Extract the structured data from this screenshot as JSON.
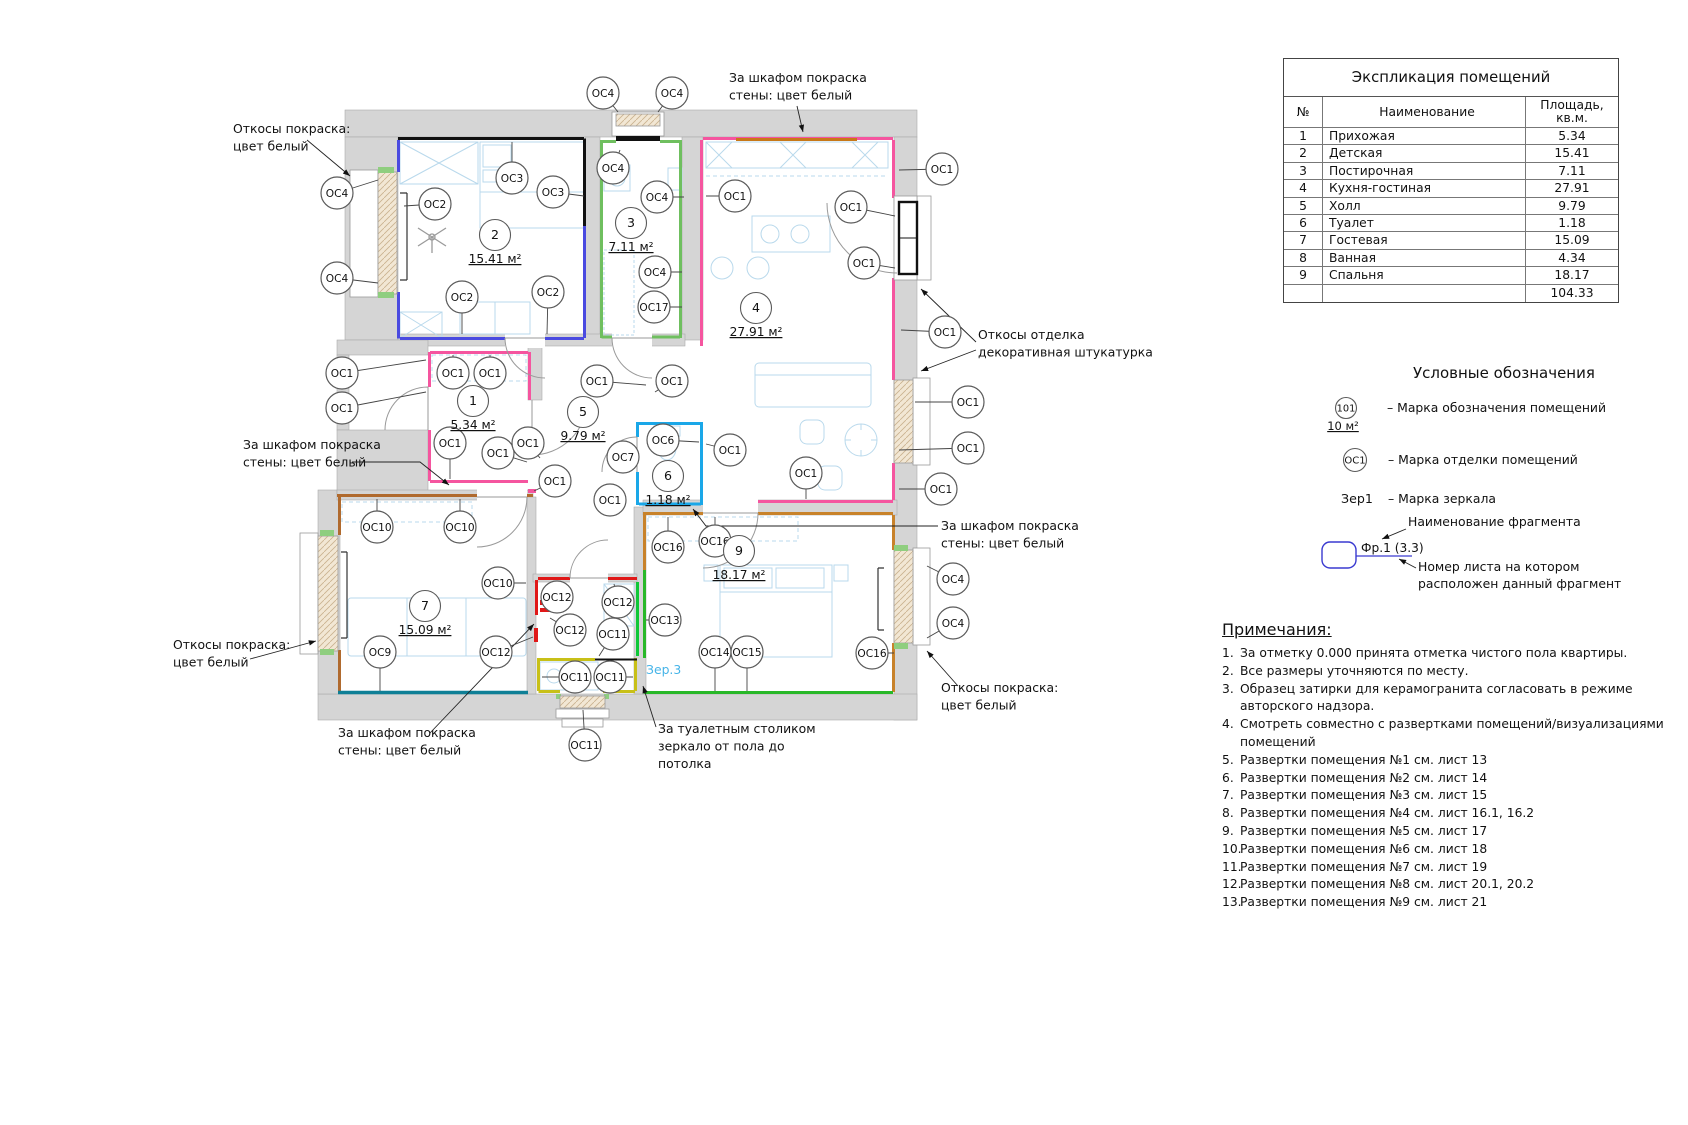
{
  "table": {
    "title": "Экспликация помещений",
    "col_no": "№",
    "col_name": "Наименование",
    "col_area": "Площадь, кв.м.",
    "rows": [
      [
        "1",
        "Прихожая",
        "5.34"
      ],
      [
        "2",
        "Детская",
        "15.41"
      ],
      [
        "3",
        "Постирочная",
        "7.11"
      ],
      [
        "4",
        "Кухня-гостиная",
        "27.91"
      ],
      [
        "5",
        "Холл",
        "9.79"
      ],
      [
        "6",
        "Туалет",
        "1.18"
      ],
      [
        "7",
        "Гостевая",
        "15.09"
      ],
      [
        "8",
        "Ванная",
        "4.34"
      ],
      [
        "9",
        "Спальня",
        "18.17"
      ]
    ],
    "total": "104.33"
  },
  "legend": {
    "title": "Условные обозначения",
    "room_mark": {
      "circle": "101",
      "area": "10 м²",
      "desc": "– Марка обозначения помещений"
    },
    "finish_mark": {
      "circle": "ОС1",
      "desc": "– Марка отделки помещений"
    },
    "mirror_mark": {
      "label": "Зер1",
      "desc": "– Марка зеркала"
    },
    "fragment": {
      "label": "Фр.1 (3.3)",
      "ann_name": "Наименование фрагмента",
      "ann_sheet_1": "Номер листа на котором",
      "ann_sheet_2": "расположен данный фрагмент"
    }
  },
  "notes": {
    "title": "Примечания:",
    "items": [
      "За отметку 0.000 принята отметка чистого пола квартиры.",
      "Все размеры уточняются по месту.",
      "Образец затирки для керамогранита согласовать в режиме авторского надзора.",
      "Смотреть совместно с развертками помещений/визуализациями помещений",
      "Развертки помещения №1 см. лист 13",
      "Развертки помещения №2 см. лист 14",
      "Развертки помещения №3 см. лист 15",
      "Развертки помещения №4 см. лист 16.1, 16.2",
      "Развертки помещения №5 см. лист 17",
      "Развертки помещения №6 см. лист 18",
      "Развертки помещения №7 см. лист 19",
      "Развертки помещения №8 см. лист 20.1, 20.2",
      "Развертки помещения №9 см. лист 21"
    ]
  },
  "plan": {
    "colors": {
      "wall_gray": "#d5d5d5",
      "blue": "#4a4ae0",
      "green_room3": "#6fbf5f",
      "pink": "#f5559f",
      "cyan": "#1aa7e8",
      "brown_room7": "#b06a2e",
      "teal": "#0e7f96",
      "brown_room9": "#c8822a",
      "green_room9": "#28b828",
      "red": "#e01818",
      "yellow": "#c8c018",
      "green_bath": "#10c838",
      "orange_wardrobe": "#c87818",
      "window_tan": "#f2e7d4",
      "furniture_blue": "#b9d9ec",
      "mirror_blue": "#46b4e8",
      "fragment_blue": "#3a3ad0"
    },
    "mirror_label": {
      "text": "Зер.3",
      "x": 646,
      "y": 674
    },
    "rooms": [
      {
        "n": "1",
        "a": "5.34 м²",
        "x": 473,
        "y": 401
      },
      {
        "n": "2",
        "a": "15.41 м²",
        "x": 495,
        "y": 235
      },
      {
        "n": "3",
        "a": "7.11 м²",
        "x": 631,
        "y": 223
      },
      {
        "n": "4",
        "a": "27.91 м²",
        "x": 756,
        "y": 308
      },
      {
        "n": "5",
        "a": "9.79 м²",
        "x": 583,
        "y": 412
      },
      {
        "n": "6",
        "a": "1.18 м²",
        "x": 668,
        "y": 476
      },
      {
        "n": "7",
        "a": "15.09 м²",
        "x": 425,
        "y": 606
      },
      {
        "n": "9",
        "a": "18.17 м²",
        "x": 739,
        "y": 551
      }
    ],
    "markers": [
      {
        "t": "ОС4",
        "x": 337,
        "y": 193,
        "tx": 378,
        "ty": 180
      },
      {
        "t": "ОС4",
        "x": 337,
        "y": 278,
        "tx": 378,
        "ty": 283
      },
      {
        "t": "ОС2",
        "x": 435,
        "y": 204,
        "tx": 404,
        "ty": 206
      },
      {
        "t": "ОС3",
        "x": 512,
        "y": 178,
        "tx": 512,
        "ty": 142
      },
      {
        "t": "ОС3",
        "x": 553,
        "y": 192,
        "tx": 584,
        "ty": 196
      },
      {
        "t": "ОС2",
        "x": 462,
        "y": 297,
        "tx": 462,
        "ty": 334
      },
      {
        "t": "ОС2",
        "x": 548,
        "y": 292,
        "tx": 547,
        "ty": 334
      },
      {
        "t": "ОС4",
        "x": 603,
        "y": 93,
        "tx": 618,
        "ty": 112
      },
      {
        "t": "ОС4",
        "x": 672,
        "y": 93,
        "tx": 658,
        "ty": 112
      },
      {
        "t": "ОС4",
        "x": 613,
        "y": 168,
        "tx": 620,
        "ty": 150
      },
      {
        "t": "ОС4",
        "x": 657,
        "y": 197,
        "tx": 684,
        "ty": 197
      },
      {
        "t": "ОС4",
        "x": 655,
        "y": 272,
        "tx": 682,
        "ty": 272
      },
      {
        "t": "ОС17",
        "x": 654,
        "y": 307,
        "tx": 682,
        "ty": 307
      },
      {
        "t": "ОС1",
        "x": 735,
        "y": 196,
        "tx": 706,
        "ty": 196
      },
      {
        "t": "ОС1",
        "x": 851,
        "y": 207,
        "tx": 895,
        "ty": 216
      },
      {
        "t": "ОС1",
        "x": 864,
        "y": 263,
        "tx": 895,
        "ty": 268
      },
      {
        "t": "ОС1",
        "x": 942,
        "y": 169,
        "tx": 899,
        "ty": 170
      },
      {
        "t": "ОС1",
        "x": 945,
        "y": 332,
        "tx": 901,
        "ty": 330
      },
      {
        "t": "ОС1",
        "x": 968,
        "y": 402,
        "tx": 915,
        "ty": 402
      },
      {
        "t": "ОС1",
        "x": 968,
        "y": 448,
        "tx": 899,
        "ty": 450
      },
      {
        "t": "ОС1",
        "x": 941,
        "y": 489,
        "tx": 899,
        "ty": 489
      },
      {
        "t": "ОС4",
        "x": 953,
        "y": 579,
        "tx": 927,
        "ty": 566
      },
      {
        "t": "ОС4",
        "x": 953,
        "y": 623,
        "tx": 927,
        "ty": 638
      },
      {
        "t": "ОС16",
        "x": 872,
        "y": 653,
        "tx": 894,
        "ty": 653
      },
      {
        "t": "ОС1",
        "x": 342,
        "y": 373,
        "tx": 426,
        "ty": 360
      },
      {
        "t": "ОС1",
        "x": 342,
        "y": 408,
        "tx": 426,
        "ty": 392
      },
      {
        "t": "ОС1",
        "x": 453,
        "y": 373,
        "tx": 453,
        "ty": 355
      },
      {
        "t": "ОС1",
        "x": 490,
        "y": 373,
        "tx": 490,
        "ty": 355
      },
      {
        "t": "ОС1",
        "x": 450,
        "y": 443,
        "tx": 450,
        "ty": 479
      },
      {
        "t": "ОС1",
        "x": 498,
        "y": 453,
        "tx": 527,
        "ty": 462
      },
      {
        "t": "ОС1",
        "x": 528,
        "y": 443,
        "tx": 540,
        "ty": 458
      },
      {
        "t": "ОС1",
        "x": 555,
        "y": 481,
        "tx": 534,
        "ty": 491
      },
      {
        "t": "ОС1",
        "x": 610,
        "y": 500,
        "tx": 601,
        "ty": 495
      },
      {
        "t": "ОС1",
        "x": 597,
        "y": 381,
        "tx": 646,
        "ty": 385
      },
      {
        "t": "ОС1",
        "x": 672,
        "y": 381,
        "tx": 655,
        "ty": 392
      },
      {
        "t": "ОС7",
        "x": 623,
        "y": 457,
        "tx": 638,
        "ty": 457
      },
      {
        "t": "ОС6",
        "x": 663,
        "y": 440,
        "tx": 699,
        "ty": 442
      },
      {
        "t": "ОС10",
        "x": 377,
        "y": 527,
        "tx": 377,
        "ty": 499
      },
      {
        "t": "ОС10",
        "x": 460,
        "y": 527,
        "tx": 460,
        "ty": 499
      },
      {
        "t": "ОС10",
        "x": 498,
        "y": 583,
        "tx": 526,
        "ty": 583
      },
      {
        "t": "ОС9",
        "x": 380,
        "y": 652,
        "tx": 380,
        "ty": 691
      },
      {
        "t": "ОС12",
        "x": 557,
        "y": 597,
        "tx": 543,
        "ty": 605
      },
      {
        "t": "ОС12",
        "x": 618,
        "y": 602,
        "tx": 614,
        "ty": 584
      },
      {
        "t": "ОС12",
        "x": 570,
        "y": 630,
        "tx": 550,
        "ty": 618
      },
      {
        "t": "ОС12",
        "x": 496,
        "y": 652,
        "tx": 533,
        "ty": 637
      },
      {
        "t": "ОС11",
        "x": 613,
        "y": 634,
        "tx": 599,
        "ty": 656
      },
      {
        "t": "ОС11",
        "x": 575,
        "y": 677,
        "tx": 542,
        "ty": 677
      },
      {
        "t": "ОС11",
        "x": 610,
        "y": 677,
        "tx": 633,
        "ty": 677
      },
      {
        "t": "ОС11",
        "x": 585,
        "y": 745,
        "tx": 583,
        "ty": 710
      },
      {
        "t": "ОС13",
        "x": 665,
        "y": 620,
        "tx": 646,
        "ty": 620
      },
      {
        "t": "ОС14",
        "x": 715,
        "y": 652,
        "tx": 715,
        "ty": 691
      },
      {
        "t": "ОС15",
        "x": 747,
        "y": 652,
        "tx": 747,
        "ty": 691
      },
      {
        "t": "ОС16",
        "x": 668,
        "y": 547,
        "tx": 668,
        "ty": 517
      },
      {
        "t": "ОС16",
        "x": 715,
        "y": 541,
        "tx": 715,
        "ty": 517
      },
      {
        "t": "ОС1",
        "x": 806,
        "y": 473,
        "tx": 806,
        "ty": 499
      },
      {
        "t": "ОС1",
        "x": 730,
        "y": 450,
        "tx": 706,
        "ty": 444
      }
    ],
    "annotations": [
      {
        "x": 233,
        "y": 133,
        "lines": [
          "Откосы покраска:",
          "цвет белый"
        ],
        "arrows": [
          [
            [
              307,
              140
            ],
            [
              350,
              176
            ]
          ]
        ]
      },
      {
        "x": 729,
        "y": 82,
        "lines": [
          "За шкафом покраска",
          "стены: цвет белый"
        ],
        "arrows": [
          [
            [
              797,
              106
            ],
            [
              803,
              132
            ]
          ]
        ]
      },
      {
        "x": 978,
        "y": 339,
        "lines": [
          "Откосы отделка",
          "декоративная штукатурка"
        ],
        "arrows": [
          [
            [
              976,
              342
            ],
            [
              921,
              289
            ]
          ],
          [
            [
              976,
              350
            ],
            [
              921,
              371
            ]
          ]
        ]
      },
      {
        "x": 941,
        "y": 530,
        "lines": [
          "За шкафом покраска",
          "стены: цвет белый"
        ],
        "arrows": [
          [
            [
              938,
              526
            ],
            [
              706,
              526
            ],
            [
              693,
              509
            ]
          ]
        ]
      },
      {
        "x": 243,
        "y": 449,
        "lines": [
          "За шкафом покраска",
          "стены: цвет белый"
        ],
        "arrows": [
          [
            [
              352,
              462
            ],
            [
              420,
              462
            ],
            [
              449,
              485
            ]
          ]
        ]
      },
      {
        "x": 173,
        "y": 649,
        "lines": [
          "Откосы покраска:",
          "цвет белый"
        ],
        "arrows": [
          [
            [
              250,
              659
            ],
            [
              316,
              641
            ]
          ]
        ]
      },
      {
        "x": 941,
        "y": 692,
        "lines": [
          "Откосы покраска:",
          "цвет белый"
        ],
        "arrows": [
          [
            [
              958,
              686
            ],
            [
              927,
              651
            ]
          ]
        ]
      },
      {
        "x": 338,
        "y": 737,
        "lines": [
          "За шкафом покраска",
          "стены: цвет белый"
        ],
        "arrows": [
          [
            [
              430,
              733
            ],
            [
              534,
              624
            ]
          ]
        ]
      },
      {
        "x": 658,
        "y": 733,
        "lines": [
          "За туалетным столиком",
          "зеркало от пола до",
          "потолка"
        ],
        "arrows": [
          [
            [
              656,
              727
            ],
            [
              643,
              686
            ]
          ]
        ]
      }
    ]
  }
}
